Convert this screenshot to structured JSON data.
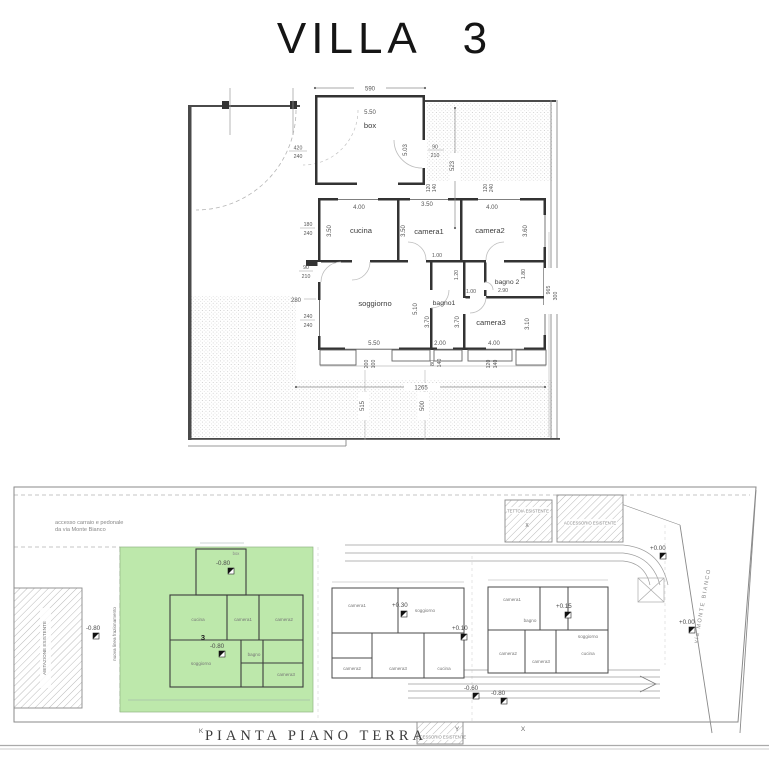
{
  "title": "VILLA 3",
  "floor_plan": {
    "rooms": {
      "box": "box",
      "cucina": "cucina",
      "camera1": "camera1",
      "camera2": "camera2",
      "soggiorno": "soggiorno",
      "bagno1": "bagno1",
      "bagno2": "bagno 2",
      "camera3": "camera3"
    },
    "dims": {
      "site_top": "590",
      "box_w": "5.50",
      "box_d": "5.03",
      "gate_w": "420",
      "gate_h": "240",
      "box_door_w": "90",
      "box_door_h": "210",
      "court_right": "523",
      "win1_w": "120",
      "win1_h": "140",
      "win2_w": "120",
      "win2_h": "240",
      "cucina_w": "4.00",
      "cucina_d": "3.50",
      "cucina_win_w": "180",
      "cucina_win_h": "240",
      "camera1_w": "3.50",
      "camera1_d": "3.50",
      "camera2_w": "4.00",
      "camera2_d": "3.60",
      "entry_w": "90",
      "entry_h": "210",
      "left_off": "280",
      "sog_win_w": "240",
      "sog_win_h": "240",
      "sog_w": "5.50",
      "sog_d": "5.10",
      "bagno1_w": "2.00",
      "bagno1_d": "3.70",
      "corridor": "1.20",
      "door1": "1.00",
      "door2": "1.00",
      "bagno2_w": "2.90",
      "bagno2_d": "1.80",
      "camera3_w": "4.00",
      "camera3_d": "3.10",
      "camera3_d2": "3.70",
      "pw1_a": "200",
      "pw1_b": "100",
      "pw2_a": "80",
      "pw2_b": "140",
      "pw3_a": "120",
      "pw3_b": "140",
      "lot_w": "1265",
      "lot_d1": "515",
      "lot_d2": "500",
      "right_d1": "965",
      "right_d2": "300"
    }
  },
  "site_plan": {
    "plan_title": "PIANTA PIANO TERRA",
    "access_note_1": "accesso carraio e pedonale",
    "access_note_2": "da via Monte Bianco",
    "abitazione": "ABITAZIONE ESISTENTE",
    "frazionamento": "nuova linea frazionamento",
    "tettoia": "TETTOIA ESISTENTE",
    "tettoia_mark": "X",
    "accessorio_top": "ACCESSORIO ESISTENTE",
    "accessorio_bottom": "ACCESSORIO ESISTENTE",
    "via": "via MONTE BIANCO",
    "villa_number": "3",
    "levels": {
      "abit": "-0.80",
      "box3": "-0.80",
      "villa3": "-0.80",
      "villa2": "+0.30",
      "mid": "+0.10",
      "villa1": "+0.15",
      "low1": "-0.60",
      "low2": "-0.80",
      "top_right": "+0.00",
      "road": "+0.00"
    },
    "markers": {
      "k": "K",
      "y": "Y",
      "x": "X"
    },
    "mini_rooms": {
      "box": "box",
      "cucina": "cucina",
      "camera1": "camera1",
      "camera2": "camera2",
      "soggiorno": "soggiorno",
      "bagno": "bagno",
      "camera3": "camera3"
    },
    "green_color": "#bde8ab"
  }
}
